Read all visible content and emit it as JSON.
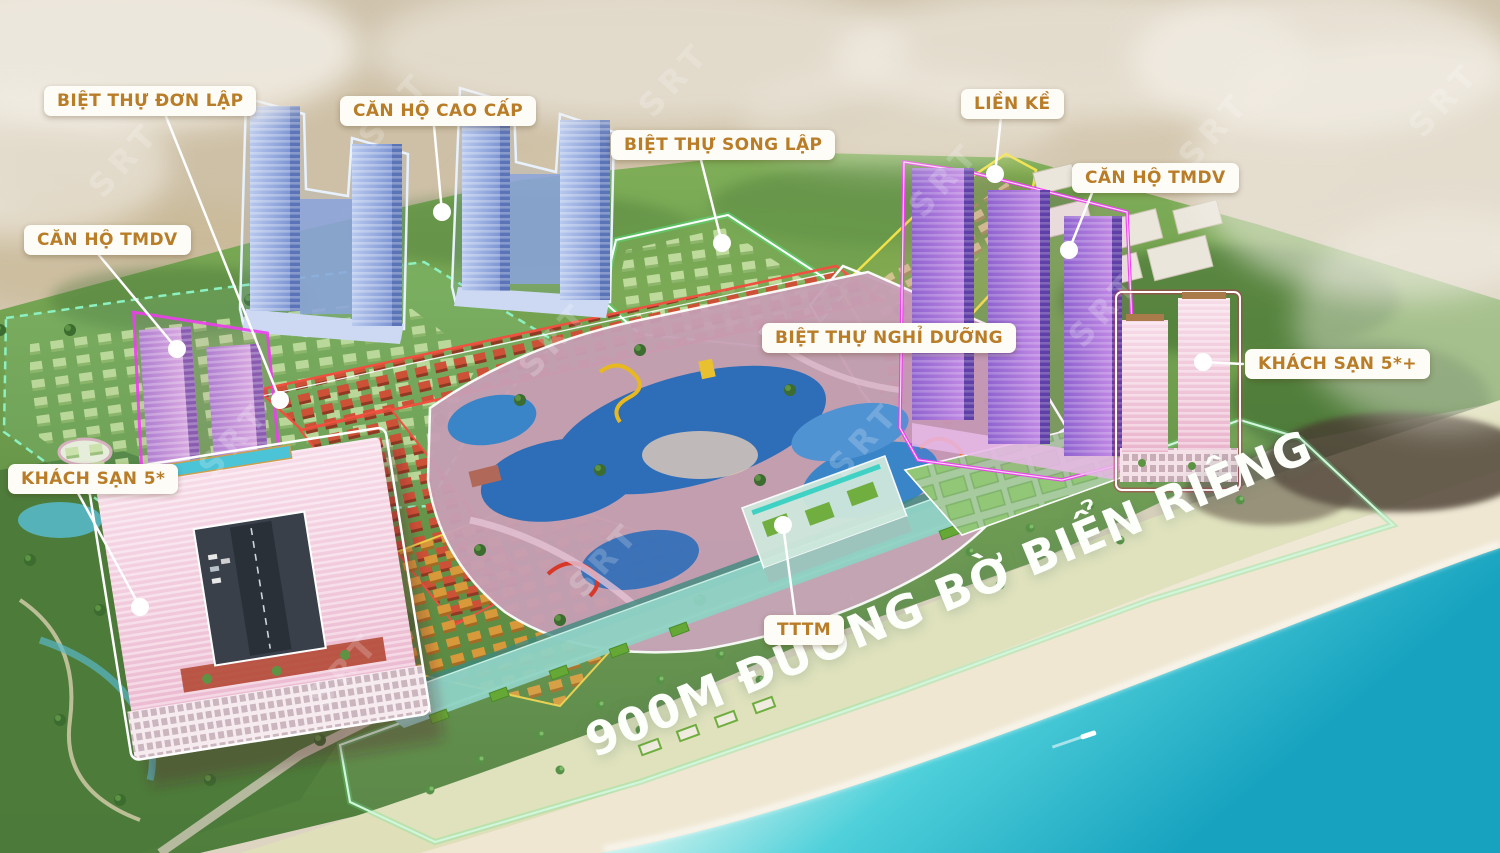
{
  "watermark": "SRT",
  "headline": "900M ĐƯỜNG BỜ BIỂN RIÊNG",
  "labels": {
    "biet_thu_don_lap": "BIỆT THỰ ĐƠN LẬP",
    "can_ho_cao_cap": "CĂN HỘ CAO CẤP",
    "biet_thu_song_lap": "BIỆT THỰ SONG LẬP",
    "lien_ke": "LIỀN KỀ",
    "can_ho_tmdv_right": "CĂN HỘ TMDV",
    "can_ho_tmdv_left": "CĂN HỘ TMDV",
    "biet_thu_nghi_duong": "BIỆT THỰ NGHỈ DƯỠNG",
    "khach_san_5_plus": "KHÁCH SẠN 5*+",
    "khach_san_5": "KHÁCH SẠN 5*",
    "tttm": "TTTM"
  },
  "colors": {
    "label_text": "#b97d28",
    "label_bg": "#fdfcf7",
    "leader_line": "#ffffff",
    "headline_text": "#fdfffb",
    "sea": "#2fc2d4",
    "sand": "#efe7d2",
    "forest": "#55823f",
    "zone_mint": "#8df0c0",
    "zone_green": "#52e87e",
    "zone_yellow": "#f2e24a",
    "zone_red": "#f05040",
    "zone_magenta": "#ee3cee",
    "zone_white": "#ffffff",
    "tower_blue": "#7e96d0",
    "tower_purple": "#9a68d4",
    "hotel_pink": "#f0c8d8"
  }
}
